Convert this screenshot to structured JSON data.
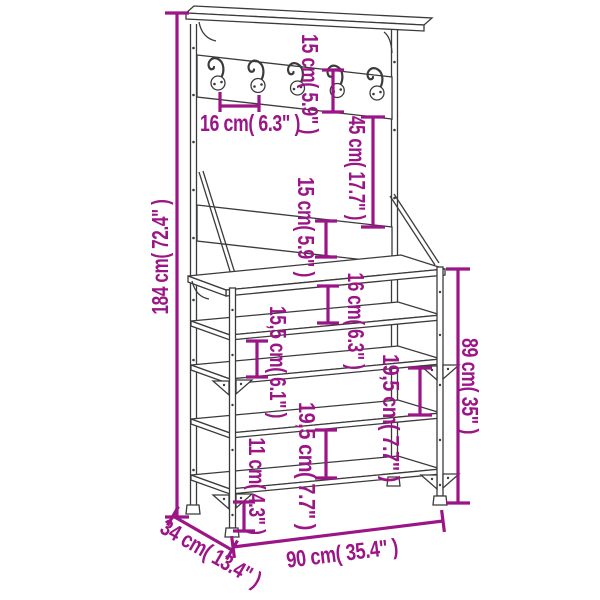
{
  "colors": {
    "dimension_accent": "#9B1586",
    "furniture_line": "#3B3B3B",
    "background": "#FFFFFF"
  },
  "product": {
    "type_hint": "clothes-rack-with-shoe-storage-dimension-diagram",
    "hook_count": 5,
    "shelf_count": 5
  },
  "dims": {
    "total_height": "184 cm( 72.4\" )",
    "hook_rail_height": "15 cm( 5.9\" )",
    "hook_spacing": "16 cm( 6.3\" )",
    "hooks_to_backboard": "45 cm( 17.7\" )",
    "backboard_height": "15 cm( 5.9\" )",
    "bench_to_shelf2": "16 cm( 6.3\" )",
    "shelf2_to_shelf3": "15,5 cm( 6.1\" )",
    "shelf3_to_shelf4": "19,5 cm( 7.7\" )",
    "shelf4_to_shelf5": "19,5 cm( 7.7\" )",
    "shelf5_to_floor": "11 cm( 4.3\" )",
    "rack_height": "89 cm( 35\" )",
    "width": "90 cm( 35.4\" )",
    "depth": "34 cm( 13.4\" )"
  }
}
